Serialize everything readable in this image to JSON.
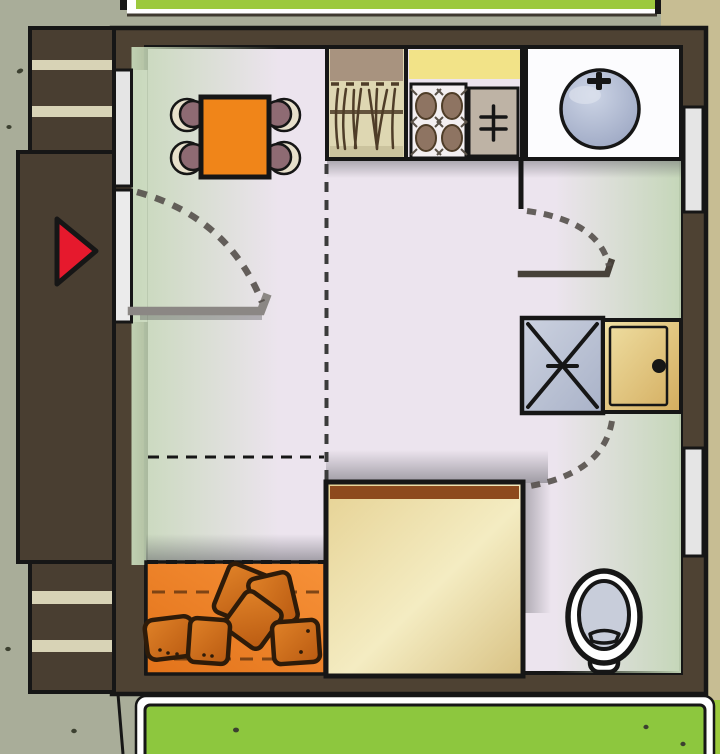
{
  "scene": {
    "description": "Hand-drawn top-down floor plan of a small studio apartment seen from above, with lawn strips outside",
    "canvas": {
      "width": 720,
      "height": 754
    }
  },
  "palette": {
    "ink": "#161616",
    "olive": "#a9ad99",
    "speck": "#3c4030",
    "path_tan": "#c7bd93",
    "lawn": "#9cc93d",
    "building_green": "#8dc73e",
    "white": "#ffffff",
    "strip_line": "#3f3a30",
    "wall": "#4e4233",
    "porch": "#493e31",
    "stripe": "#d8d3b6",
    "floor": "#ece4ee",
    "window": "#e5e5e5",
    "door_white": "#ebebeb",
    "table": "#f08519",
    "chair_back": "#e7e0cb",
    "chair_seat": "#8e6b73",
    "sofa_rug": "#ee8121",
    "pillow_ink": "#2e1b09",
    "rug_line": "#6b3a12",
    "headboard": "#8d4a1d",
    "cab_top": "#a8937f",
    "cab_body": "#ded7b2",
    "cab_band": "#cbc39e",
    "cab_line": "#4f3d28",
    "counter": "#f2e388",
    "stove": "#f3eff1",
    "burner": "#8e7462",
    "burner_tick": "#5a5248",
    "appliance": "#beb3a5",
    "sinkroom": "#fcfcfe",
    "toilet_bowl": "#c8cdda",
    "red_marker": "#e6192d",
    "leaf": "#8b8784",
    "leaf_dark": "#474139",
    "dash": "#55504b"
  },
  "objects": [
    "entrance-marker-triangle",
    "entry-steps",
    "entry-window",
    "entrance-door-open",
    "dining-table",
    "dining-chair",
    "tall-kitchen-cabinet",
    "kitchen-counter",
    "stove",
    "small-appliance",
    "kitchen-sink",
    "bathroom-stub-wall",
    "bathroom-door-open",
    "shower",
    "bathroom-cabinet",
    "toilet",
    "bed",
    "cushion-rug",
    "floor-cushion",
    "right-wall-window",
    "door-swing-arc",
    "zone-divider-dashed",
    "lawn-strip",
    "neighbor-building"
  ],
  "counts": {
    "dining_chairs": 4,
    "floor_cushions": 6,
    "stove_burners": 4,
    "right_wall_windows": 2,
    "porch_steps_blocks": 2
  }
}
